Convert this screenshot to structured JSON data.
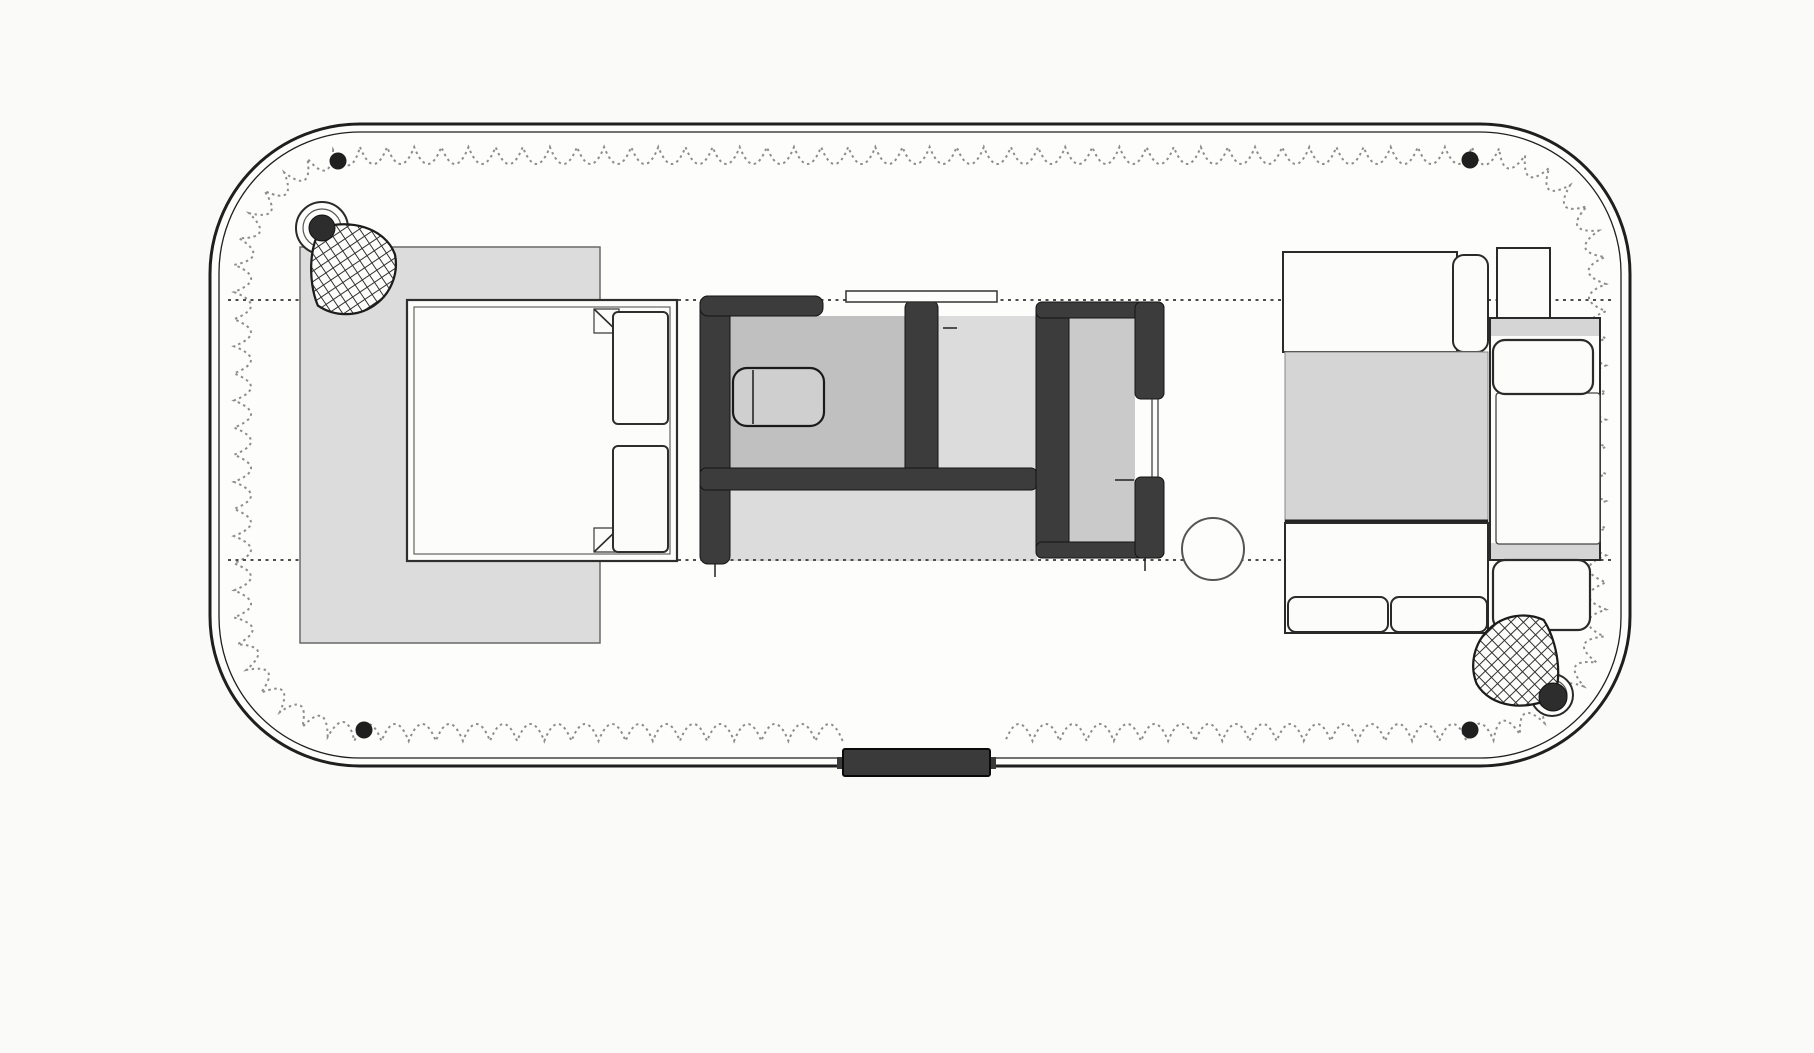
{
  "canvas": {
    "width": 1814,
    "height": 1053,
    "background": "#fafaf9"
  },
  "palette": {
    "paper": "#fafaf9",
    "shell_fill": "#fdfdfc",
    "line_dark": "#1f1f1f",
    "wall_fill": "#3c3c3c",
    "wall_stroke": "#141414",
    "light_gray": "#dcdcdc",
    "mid_gray": "#c0c0c0",
    "table_gray": "#d5d5d5",
    "scallop_gray": "#8d8d8d",
    "guide_gray": "#4d4d4d",
    "white": "#fcfcfa",
    "rivet_black": "#1f1f1f"
  },
  "shell": {
    "outer": {
      "x": 210,
      "y": 124,
      "w": 1420,
      "h": 642,
      "r": 150,
      "sw": 3
    },
    "inner": {
      "x": 219,
      "y": 132,
      "w": 1402,
      "h": 626,
      "r": 141,
      "sw": 1.3
    },
    "scallop": {
      "x": 234,
      "y": 147,
      "w": 1372,
      "h": 594,
      "r": 126,
      "period": 27,
      "depth": 17,
      "gaps": [
        {
          "x1": 830,
          "x2": 1000,
          "ymin": 700
        }
      ]
    }
  },
  "guide_lines": [
    {
      "name": "upper-guide-dotted-line",
      "y": 300,
      "x1": 228,
      "x2": 1612
    },
    {
      "name": "lower-guide-dotted-line",
      "y": 560,
      "x1": 228,
      "x2": 1612
    }
  ],
  "rivets": [
    [
      338,
      161
    ],
    [
      1470,
      160
    ],
    [
      364,
      730
    ],
    [
      1470,
      730
    ]
  ],
  "rivet_r": 8.5,
  "floors": [
    {
      "name": "bathroom-floor",
      "kind": "rect",
      "x": 703,
      "y": 316,
      "w": 334,
      "h": 245,
      "fill": "#dcdcdc"
    },
    {
      "name": "shower-floor",
      "kind": "rect",
      "x": 730,
      "y": 316,
      "w": 178,
      "h": 154,
      "fill": "#c0c0c0"
    },
    {
      "name": "wardrobe-floor",
      "kind": "rect",
      "x": 1069,
      "y": 318,
      "w": 66,
      "h": 225,
      "fill": "#cacaca"
    }
  ],
  "furniture": [
    {
      "name": "bed-duvet",
      "kind": "rect",
      "x": 300,
      "y": 247,
      "w": 300,
      "h": 396,
      "fill": "#dcdcdc",
      "stroke": "#6a6a6a",
      "sw": 1.5
    },
    {
      "name": "bed-mattress",
      "kind": "rect",
      "x": 407,
      "y": 300,
      "w": 270,
      "h": 261,
      "fill": "#fcfcfa",
      "stroke": "#2e2e2e",
      "sw": 2.2
    },
    {
      "name": "bed-mattress-inner-line",
      "kind": "rect",
      "x": 414,
      "y": 307,
      "w": 256,
      "h": 247,
      "fill": "none",
      "stroke": "#555555",
      "sw": 1.1
    },
    {
      "name": "bed-sheet-fold-top",
      "kind": "polygon",
      "points": "594,309 619,309 619,333 594,333",
      "fill": "#fcfcfa",
      "stroke": "#3a3a3a",
      "sw": 1.2
    },
    {
      "name": "bed-sheet-fold-top-crease",
      "kind": "line",
      "x1": 594,
      "y1": 309,
      "x2": 619,
      "y2": 333,
      "stroke": "#2e2e2e",
      "sw": 1.6
    },
    {
      "name": "bed-sheet-fold-bottom",
      "kind": "polygon",
      "points": "594,528 619,528 619,552 594,552",
      "fill": "#fcfcfa",
      "stroke": "#3a3a3a",
      "sw": 1.2
    },
    {
      "name": "bed-sheet-fold-bottom-crease",
      "kind": "line",
      "x1": 594,
      "y1": 552,
      "x2": 619,
      "y2": 528,
      "stroke": "#2e2e2e",
      "sw": 1.6
    },
    {
      "name": "bed-pillow-top",
      "kind": "rect",
      "x": 613,
      "y": 312,
      "w": 55,
      "h": 112,
      "rx": 5,
      "fill": "#fcfcfa",
      "stroke": "#2e2e2e",
      "sw": 2
    },
    {
      "name": "bed-pillow-bottom",
      "kind": "rect",
      "x": 613,
      "y": 446,
      "w": 55,
      "h": 106,
      "rx": 5,
      "fill": "#fcfcfa",
      "stroke": "#2e2e2e",
      "sw": 2
    },
    {
      "name": "bath-wall-left",
      "kind": "rect",
      "x": 700,
      "y": 296,
      "w": 30,
      "h": 268,
      "rx": 8,
      "fill": "#3c3c3c",
      "stroke": "#141414",
      "sw": 1
    },
    {
      "name": "bath-wall-top",
      "kind": "rect",
      "x": 700,
      "y": 296,
      "w": 123,
      "h": 20,
      "rx": 8,
      "fill": "#3c3c3c",
      "stroke": "#141414",
      "sw": 1
    },
    {
      "name": "bath-wall-right",
      "kind": "rect",
      "x": 905,
      "y": 300,
      "w": 33,
      "h": 190,
      "rx": 8,
      "fill": "#3c3c3c",
      "stroke": "#141414",
      "sw": 1
    },
    {
      "name": "bath-wall-mid",
      "kind": "rect",
      "x": 700,
      "y": 468,
      "w": 337,
      "h": 22,
      "rx": 6,
      "fill": "#3c3c3c",
      "stroke": "#141414",
      "sw": 1
    },
    {
      "name": "toilet",
      "kind": "rect",
      "x": 733,
      "y": 368,
      "w": 91,
      "h": 58,
      "rx": 14,
      "fill": "#cfcfcf",
      "stroke": "#1a1a1a",
      "sw": 2.2
    },
    {
      "name": "toilet-tank-divider",
      "kind": "line",
      "x1": 753,
      "y1": 370,
      "x2": 753,
      "y2": 424,
      "stroke": "#1a1a1a",
      "sw": 1.5
    },
    {
      "name": "bath-sliding-door-panel",
      "kind": "rect",
      "x": 846,
      "y": 291,
      "w": 151,
      "h": 11,
      "fill": "#fdfdfc",
      "stroke": "#333333",
      "sw": 1.5
    },
    {
      "name": "bath-door-handle-tick",
      "kind": "line",
      "x1": 943,
      "y1": 328,
      "x2": 957,
      "y2": 328,
      "stroke": "#222222",
      "sw": 1.5
    },
    {
      "name": "bath-wall-left-tick",
      "kind": "line",
      "x1": 715,
      "y1": 564,
      "x2": 715,
      "y2": 577,
      "stroke": "#222222",
      "sw": 1.5
    },
    {
      "name": "wardrobe-wall-left",
      "kind": "rect",
      "x": 1036,
      "y": 302,
      "w": 33,
      "h": 256,
      "rx": 8,
      "fill": "#3c3c3c",
      "stroke": "#141414",
      "sw": 1
    },
    {
      "name": "wardrobe-wall-top",
      "kind": "rect",
      "x": 1036,
      "y": 302,
      "w": 128,
      "h": 16,
      "rx": 6,
      "fill": "#3c3c3c",
      "stroke": "#141414",
      "sw": 1
    },
    {
      "name": "wardrobe-wall-bottom",
      "kind": "rect",
      "x": 1036,
      "y": 542,
      "w": 128,
      "h": 16,
      "rx": 6,
      "fill": "#3c3c3c",
      "stroke": "#141414",
      "sw": 1
    },
    {
      "name": "wardrobe-wall-right-upper",
      "kind": "rect",
      "x": 1135,
      "y": 302,
      "w": 29,
      "h": 97,
      "rx": 6,
      "fill": "#3c3c3c",
      "stroke": "#141414",
      "sw": 1
    },
    {
      "name": "wardrobe-wall-right-lower",
      "kind": "rect",
      "x": 1135,
      "y": 477,
      "w": 29,
      "h": 81,
      "rx": 6,
      "fill": "#3c3c3c",
      "stroke": "#141414",
      "sw": 1
    },
    {
      "name": "wardrobe-door-track-1",
      "kind": "line",
      "x1": 1152,
      "y1": 399,
      "x2": 1152,
      "y2": 477,
      "stroke": "#333333",
      "sw": 1.2
    },
    {
      "name": "wardrobe-door-track-2",
      "kind": "line",
      "x1": 1158,
      "y1": 399,
      "x2": 1158,
      "y2": 477,
      "stroke": "#333333",
      "sw": 1.2
    },
    {
      "name": "wardrobe-handle-tick",
      "kind": "line",
      "x1": 1115,
      "y1": 480,
      "x2": 1134,
      "y2": 480,
      "stroke": "#222222",
      "sw": 1.5
    },
    {
      "name": "wardrobe-bottom-tick",
      "kind": "line",
      "x1": 1145,
      "y1": 558,
      "x2": 1145,
      "y2": 571,
      "stroke": "#222222",
      "sw": 1.5
    },
    {
      "name": "pedestal-table",
      "kind": "circle",
      "cx": 1213,
      "cy": 549,
      "r": 31,
      "fill": "#fdfdfc",
      "stroke": "#555555",
      "sw": 2
    },
    {
      "name": "dinette-top-bench",
      "kind": "rect",
      "x": 1283,
      "y": 252,
      "w": 174,
      "h": 100,
      "fill": "#fcfcfa",
      "stroke": "#2a2a2a",
      "sw": 2
    },
    {
      "name": "dinette-top-bench-back-cushion",
      "kind": "rect",
      "x": 1453,
      "y": 255,
      "w": 35,
      "h": 97,
      "rx": 11,
      "fill": "#fcfcfa",
      "stroke": "#2a2a2a",
      "sw": 2
    },
    {
      "name": "side-table",
      "kind": "rect",
      "x": 1497,
      "y": 248,
      "w": 53,
      "h": 70,
      "fill": "#fcfcfa",
      "stroke": "#2a2a2a",
      "sw": 2
    },
    {
      "name": "dinette-table",
      "kind": "rect",
      "x": 1285,
      "y": 352,
      "w": 203,
      "h": 171,
      "fill": "#d5d5d5",
      "stroke": "#888888",
      "sw": 1
    },
    {
      "name": "dinette-table-edge",
      "kind": "line",
      "x1": 1285,
      "y1": 521,
      "x2": 1488,
      "y2": 521,
      "stroke": "#222222",
      "sw": 3
    },
    {
      "name": "dinette-bottom-bench",
      "kind": "rect",
      "x": 1285,
      "y": 523,
      "w": 203,
      "h": 110,
      "fill": "#fcfcfa",
      "stroke": "#2a2a2a",
      "sw": 2
    },
    {
      "name": "dinette-bottom-cushion-left",
      "kind": "rect",
      "x": 1288,
      "y": 597,
      "w": 100,
      "h": 35,
      "rx": 8,
      "fill": "#fcfcfa",
      "stroke": "#2a2a2a",
      "sw": 2
    },
    {
      "name": "dinette-bottom-cushion-right",
      "kind": "rect",
      "x": 1391,
      "y": 597,
      "w": 96,
      "h": 35,
      "rx": 8,
      "fill": "#fcfcfa",
      "stroke": "#2a2a2a",
      "sw": 2
    },
    {
      "name": "sofa-frame",
      "kind": "rect",
      "x": 1490,
      "y": 318,
      "w": 110,
      "h": 242,
      "fill": "#fcfcfa",
      "stroke": "#2a2a2a",
      "sw": 2
    },
    {
      "name": "sofa-strip-top",
      "kind": "rect",
      "x": 1491,
      "y": 319,
      "w": 108,
      "h": 17,
      "fill": "#d5d5d5"
    },
    {
      "name": "sofa-strip-bottom",
      "kind": "rect",
      "x": 1491,
      "y": 543,
      "w": 108,
      "h": 16,
      "fill": "#d5d5d5"
    },
    {
      "name": "sofa-seat",
      "kind": "rect",
      "x": 1496,
      "y": 393,
      "w": 104,
      "h": 151,
      "rx": 3,
      "fill": "#fcfcfa",
      "stroke": "#444444",
      "sw": 1.3
    },
    {
      "name": "sofa-cushion-top",
      "kind": "rect",
      "x": 1493,
      "y": 340,
      "w": 100,
      "h": 54,
      "rx": 12,
      "fill": "#fcfcfa",
      "stroke": "#2a2a2a",
      "sw": 2.2
    },
    {
      "name": "sofa-cushion-bottom",
      "kind": "rect",
      "x": 1493,
      "y": 560,
      "w": 97,
      "h": 70,
      "rx": 12,
      "fill": "#fcfcfa",
      "stroke": "#2a2a2a",
      "sw": 2.2
    }
  ],
  "entry_step": {
    "body": {
      "x": 843,
      "y": 749,
      "w": 147,
      "h": 27,
      "rx": 2,
      "fill": "#3a3a3a",
      "stroke": "#0a0a0a",
      "sw": 2
    },
    "nubs": [
      {
        "x": 837,
        "y": 757,
        "w": 7,
        "h": 12
      },
      {
        "x": 989,
        "y": 757,
        "w": 7,
        "h": 12
      }
    ]
  },
  "lamps": [
    {
      "name": "bed-reading-lamp",
      "ring": {
        "cx": 322,
        "cy": 228,
        "r": 26
      },
      "ring2_r": 19,
      "blob": {
        "cx": 322,
        "cy": 228,
        "r": 13
      },
      "fan": {
        "x": 322,
        "y": 228,
        "rot": 18,
        "scale": 1.25
      }
    },
    {
      "name": "sofa-reading-lamp",
      "ring": {
        "cx": 1552,
        "cy": 695,
        "r": 21
      },
      "ring2_r": 15,
      "blob": {
        "cx": 1553,
        "cy": 697,
        "r": 14
      },
      "fan": {
        "x": 1553,
        "y": 697,
        "rot": 188,
        "scale": 1.25
      }
    }
  ]
}
